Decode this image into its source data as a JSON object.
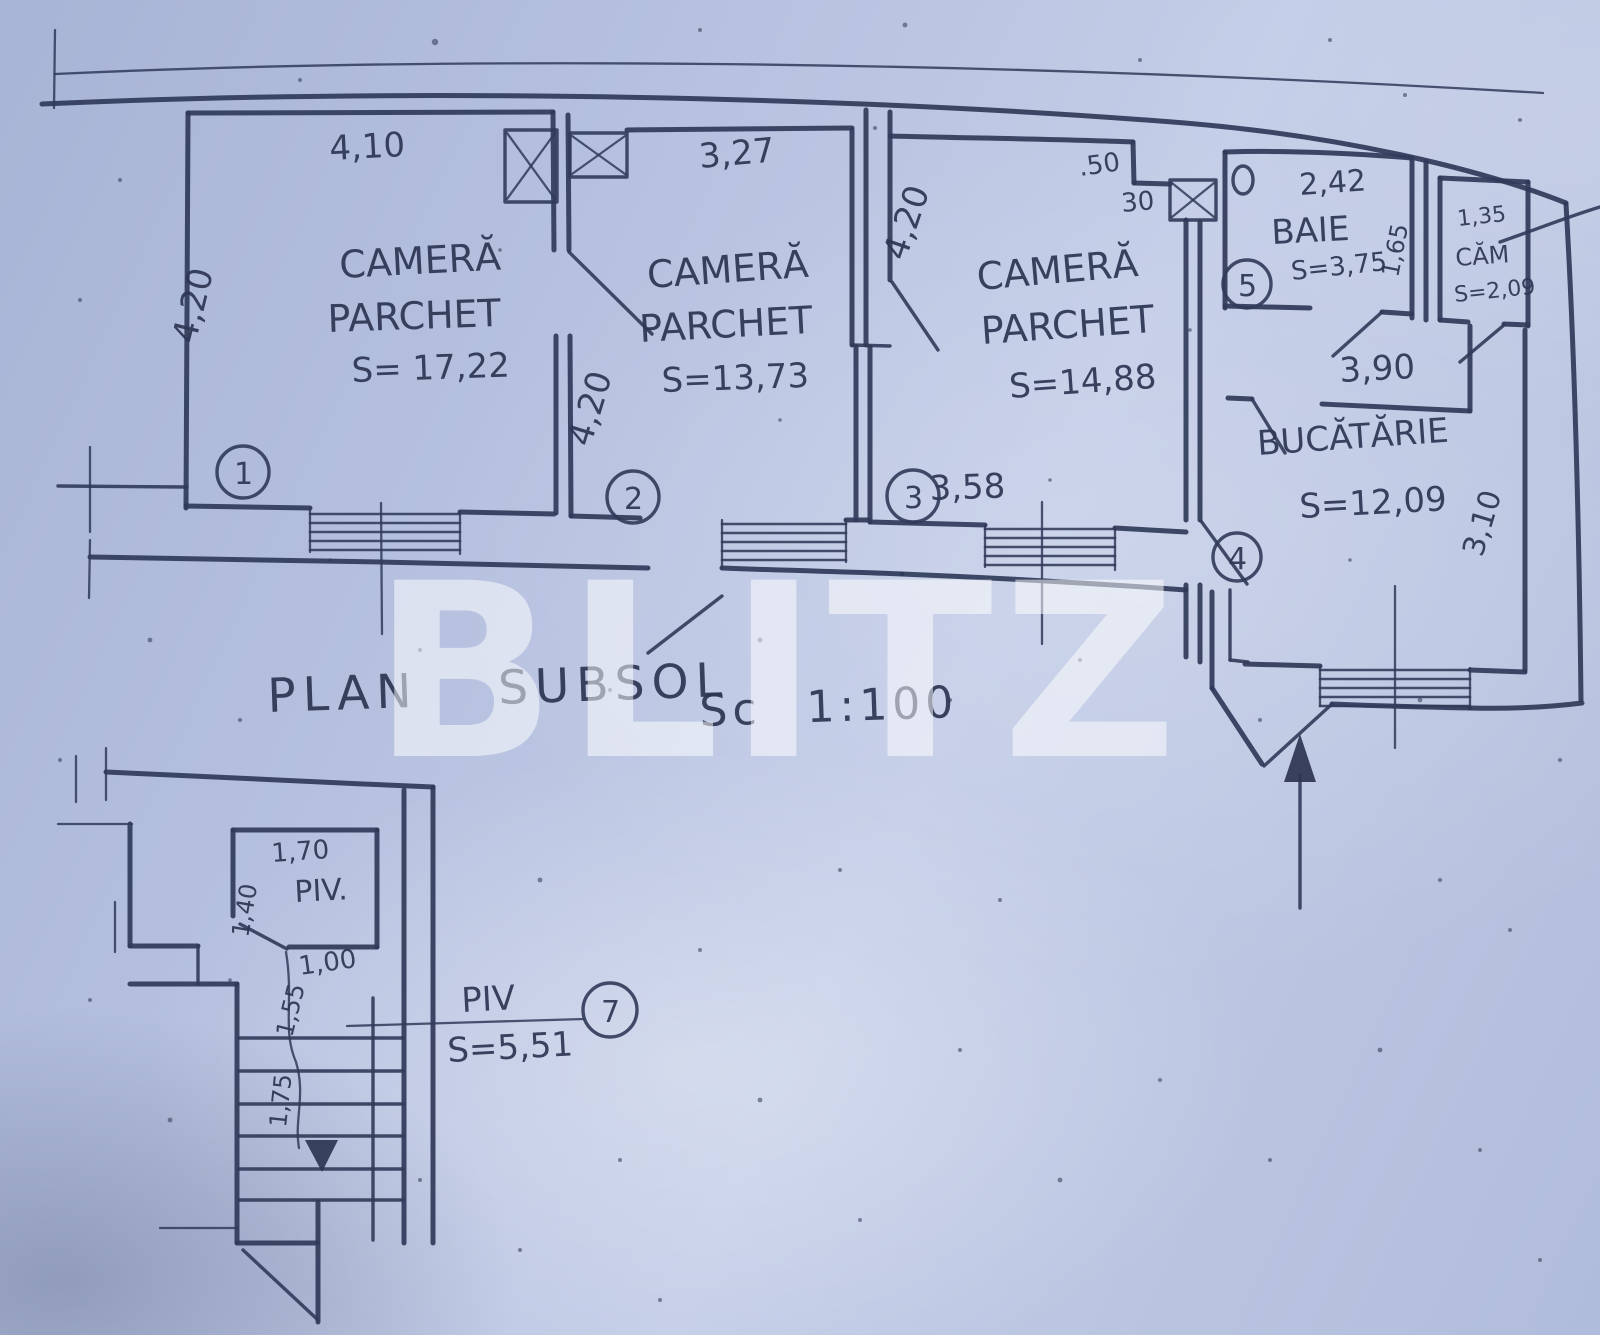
{
  "watermark": "BLITZ",
  "title": {
    "main": "PLAN SUBSOL",
    "scale": "Sc 1:100"
  },
  "main_plan": {
    "room1": {
      "name1": "CAMERĂ",
      "name2": "PARCHET",
      "area": "S= 17,22",
      "number": "1",
      "dim_top": "4,10",
      "dim_left": "4,20"
    },
    "room2": {
      "name1": "CAMERĂ",
      "name2": "PARCHET",
      "area": "S=13,73",
      "number": "2",
      "dim_top": "3,27",
      "dim_left": "4,20",
      "dim_right": "4,20"
    },
    "room3": {
      "name1": "CAMERĂ",
      "name2": "PARCHET",
      "area": "S=14,88",
      "number": "3",
      "dim_bottom": "3,58",
      "dim_step_a": ".50",
      "dim_step_b": "30"
    },
    "baie": {
      "name": "BAIE",
      "area": "S=3,75",
      "number": "5",
      "dim_top": "2,42",
      "dim_side": "1,65"
    },
    "cam": {
      "name": "CĂM",
      "area": "S=2,09",
      "dim_top": "1,35"
    },
    "hall": {
      "dim_width": "3,90"
    },
    "bucatarie": {
      "name": "BUCĂTĂRIE",
      "area": "S=12,09",
      "number": "4",
      "dim_right": "3,10"
    }
  },
  "lower_plan": {
    "piv_room": {
      "name": "PIV.",
      "dim_top": "1,70",
      "dim_left": "1,40",
      "dim_door": "1,00",
      "dim_a": "1,55",
      "dim_b": "1,75"
    },
    "callout": {
      "name": "PIV",
      "number": "7",
      "area": "S=5,51"
    }
  }
}
